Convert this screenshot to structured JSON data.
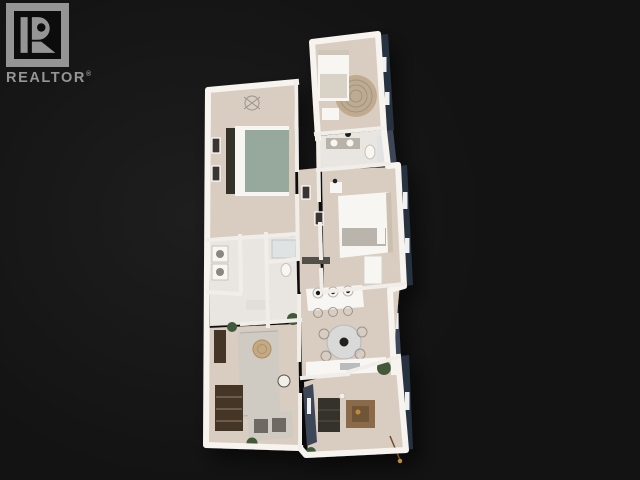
{
  "logo": {
    "text": "REALTOR",
    "registered": "®"
  },
  "scene": {
    "description": "3D dollhouse-style floor plan rendering of an apartment on a black background"
  },
  "colors": {
    "background": "#131313",
    "background_glow": "#1e1e1e",
    "wall": "#f7f4f0",
    "wall_inner": "#f1eee9",
    "wall_shadow": "#cfc9c1",
    "floor": "#d8cdc0",
    "floor_light": "#e9e6e1",
    "exterior_dark": "#28303f",
    "exterior_mid": "#3c4658",
    "exterior_light": "#5e6c80",
    "wood_dark": "#453627",
    "wood_mid": "#8a6a48",
    "wood_tray": "#6f5438",
    "charcoal": "#34302b",
    "textile_grey": "#cfcac2",
    "rug_tan": "#c0ab8e",
    "rug_tan_dark": "#a78e68",
    "duvet_sage": "#97a89c",
    "greenery": "#42593b",
    "logo_grey": "#969595",
    "accent_gold": "#c08a3e"
  }
}
